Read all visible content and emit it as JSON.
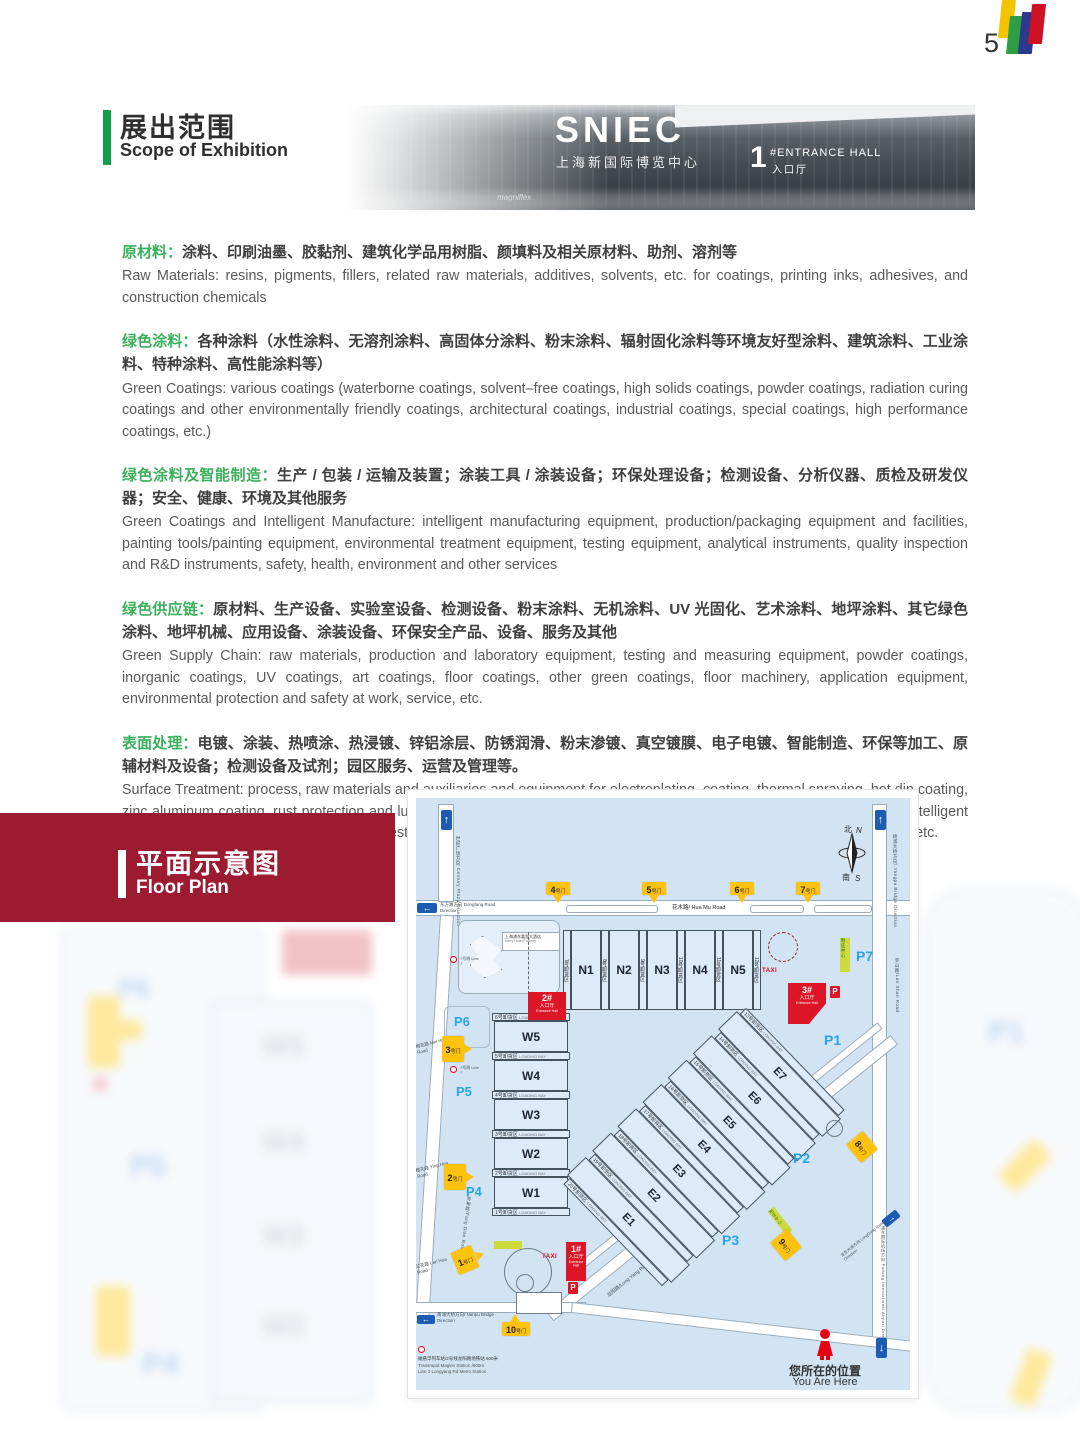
{
  "page": {
    "number": "5"
  },
  "scope": {
    "title_zh": "展出范围",
    "title_en": "Scope of Exhibition",
    "photo": {
      "sniec": "SNIEC",
      "sniec_zh": "上海新国际博览中心",
      "hall_num": "1",
      "hall_en": "#ENTRANCE HALL",
      "hall_zh": "入口厅",
      "brand": "magniflex"
    },
    "sections": [
      {
        "label": "原材料：",
        "zh": "涂料、印刷油墨、胶黏剂、建筑化学品用树脂、颜填料及相关原材料、助剂、溶剂等",
        "en": "Raw Materials: resins, pigments, fillers, related raw materials, additives, solvents, etc. for coatings, printing inks, adhesives, and construction chemicals"
      },
      {
        "label": "绿色涂料：",
        "zh": "各种涂料（水性涂料、无溶剂涂料、高固体分涂料、粉末涂料、辐射固化涂料等环境友好型涂料、建筑涂料、工业涂料、特种涂料、高性能涂料等）",
        "en": "Green Coatings: various coatings (waterborne coatings, solvent–free coatings, high solids coatings, powder coatings, radiation curing coatings and other environmentally friendly coatings, architectural coatings, industrial coatings, special coatings, high performance coatings, etc.)"
      },
      {
        "label": "绿色涂料及智能制造：",
        "zh": "生产 / 包装 / 运输及装置；涂装工具 / 涂装设备；环保处理设备；检测设备、分析仪器、质检及研发仪器；安全、健康、环境及其他服务",
        "en": "Green Coatings and Intelligent Manufacture: intelligent manufacturing equipment, production/packaging equipment and facilities, painting tools/painting equipment, environmental treatment equipment, testing equipment, analytical instruments, quality inspection and R&D instruments, safety, health, environment and other services"
      },
      {
        "label": "绿色供应链：",
        "zh": "原材料、生产设备、实验室设备、检测设备、粉末涂料、无机涂料、UV 光固化、艺术涂料、地坪涂料、其它绿色涂料、地坪机械、应用设备、涂装设备、环保安全产品、设备、服务及其他",
        "en": "Green Supply Chain: raw materials, production and laboratory equipment, testing and measuring equipment, powder coatings, inorganic coatings, UV coatings, art coatings, floor coatings, other green coatings, floor machinery, application equipment, environmental protection and safety at work, service, etc."
      },
      {
        "label": "表面处理：",
        "zh": "电镀、涂装、热喷涂、热浸镀、锌铝涂层、防锈润滑、粉末渗镀、真空镀膜、电子电镀、智能制造、环保等加工、原辅材料及设备；检测设备及试剂；园区服务、运营及管理等。",
        "en": "Surface Treatment: process, raw materials and auxiliaries and equipment for electroplating, coating, thermal spraying, hot dip coating, zinc aluminum coating, rust protection and lubrication, powder infiltration plating, vacuum coating, electronic electroplating, intelligent manufacturing, environmental protection; testing equipment and reagent; industrial park service, operation and management, etc."
      }
    ]
  },
  "fp": {
    "title_zh": "平面示意图",
    "title_en": "Floor Plan",
    "map": {
      "compass": {
        "n_zh": "北",
        "n_en": "N",
        "s_zh": "南",
        "s_en": "S"
      },
      "halls_n": [
        "N1",
        "N2",
        "N3",
        "N4",
        "N5"
      ],
      "halls_w": [
        "W5",
        "W4",
        "W3",
        "W2",
        "W1"
      ],
      "halls_e": [
        "E7",
        "E6",
        "E5",
        "E4",
        "E3",
        "E2",
        "E1"
      ],
      "bays_n": [
        "7号卸货区",
        "8号卸货区",
        "9号卸货区",
        "10号卸货区",
        "11号卸货区",
        "12号卸货区"
      ],
      "bays_w": [
        "6号卸货区",
        "5号卸货区",
        "4号卸货区",
        "3号卸货区",
        "2号卸货区",
        "1号卸货区"
      ],
      "bays_e": [
        "13号卸货区",
        "14号卸货区",
        "15号卸货区",
        "16号卸货区",
        "17号卸货区",
        "18号卸货区",
        "19号卸货区",
        "20号卸货区"
      ],
      "loading_bay": "LOADING BAY",
      "gate_suffix": "号门",
      "gate_nums": [
        "1",
        "2",
        "3",
        "4",
        "5",
        "6",
        "7",
        "8",
        "9",
        "10"
      ],
      "parking": [
        "P1",
        "P2",
        "P3",
        "P4",
        "P5",
        "P6",
        "P7"
      ],
      "entrance": {
        "n1": "1#",
        "n2": "2#",
        "n3": "3#",
        "zh": "入口厅",
        "en": "Entrance Hall"
      },
      "p_sign": "P",
      "taxi": "TAXI",
      "badge_center": "制证中心",
      "hotel": {
        "zh": "上海浦东嘉里大酒店",
        "en": "Kerry Hotel Pudong"
      },
      "metro7": "7号线 Line 7",
      "roads": {
        "huamu": "花木路/ Hua Mu Road",
        "longyang": "龙阳路/Long Yang Road",
        "meihua": "梅花路 Mei Hua Road",
        "yinghua": "樱花路 Ying Hua Road",
        "lanhua": "兰花路 Lan Hua Road",
        "fangdian": "芳甸路/Fang Dian Road",
        "luoshan": "罗山路/Luo Shan Road"
      },
      "directions": {
        "dongfang": "东方路方向 Dongfang Road Direction",
        "nanpu": "南浦大桥方向/ Nanpu Bridge Direction",
        "yangpu": "杨浦大桥方向/ Yangpu Bridge Direction",
        "airport": "浦东国际机场方向 Pudong International Airport Direction",
        "longdong": "龙东大道方向 LongDong Road Direction",
        "century": "世纪广场方向 Century Plaza Direction"
      },
      "you_are_here": {
        "zh": "您所在的位置",
        "en": "You Are Here"
      },
      "transit": {
        "zh": "磁悬浮列车站/2号线龙阳路地铁站 600米",
        "en1": "Transrapid Maglev Station /600m",
        "en2": "Line 2 Longyang Rd Metro Station"
      }
    }
  }
}
